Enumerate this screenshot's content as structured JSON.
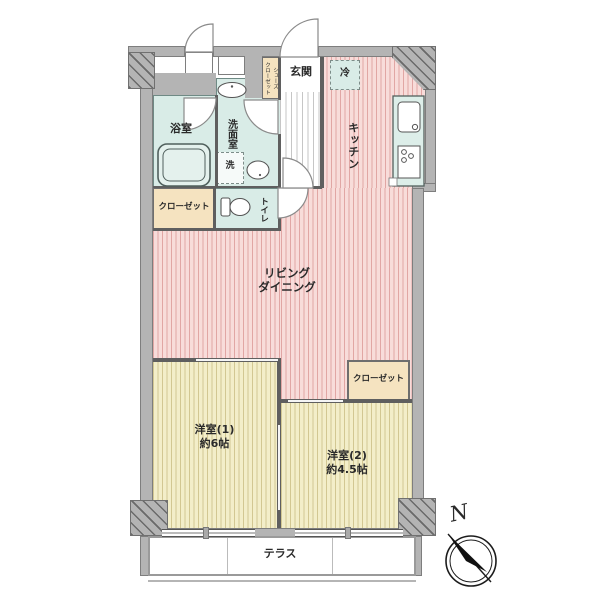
{
  "floorplan": {
    "rooms": {
      "entrance": {
        "label": "玄関"
      },
      "refrigerator": {
        "label": "冷"
      },
      "kitchen": {
        "label": "キッチン"
      },
      "bathroom": {
        "label": "浴室"
      },
      "washroom": {
        "label": "洗面室"
      },
      "washer": {
        "label": "洗"
      },
      "shoes_closet": {
        "line1": "シューズ",
        "line2": "クローゼット"
      },
      "closet_hall": {
        "label": "クローゼット"
      },
      "toilet": {
        "label": "トイレ"
      },
      "living_dining": {
        "line1": "リビング",
        "line2": "ダイニング"
      },
      "western_room_1": {
        "name": "洋室(1)",
        "size": "約6帖"
      },
      "western_room_2": {
        "name": "洋室(2)",
        "size": "約4.5帖"
      },
      "closet_room2": {
        "label": "クローゼット"
      },
      "terrace": {
        "label": "テラス"
      }
    },
    "compass": {
      "north": "N"
    },
    "colors": {
      "wall": "#b4b4b4",
      "wall_edge": "#7e7e7e",
      "interior_wall": "#5f5f5f",
      "living_floor": "#f8dcda",
      "room_floor": "#f3eec9",
      "wet_area": "#d9ece7",
      "closet": "#f5e3c0",
      "hall_stripe": "#c6c6c6"
    }
  }
}
